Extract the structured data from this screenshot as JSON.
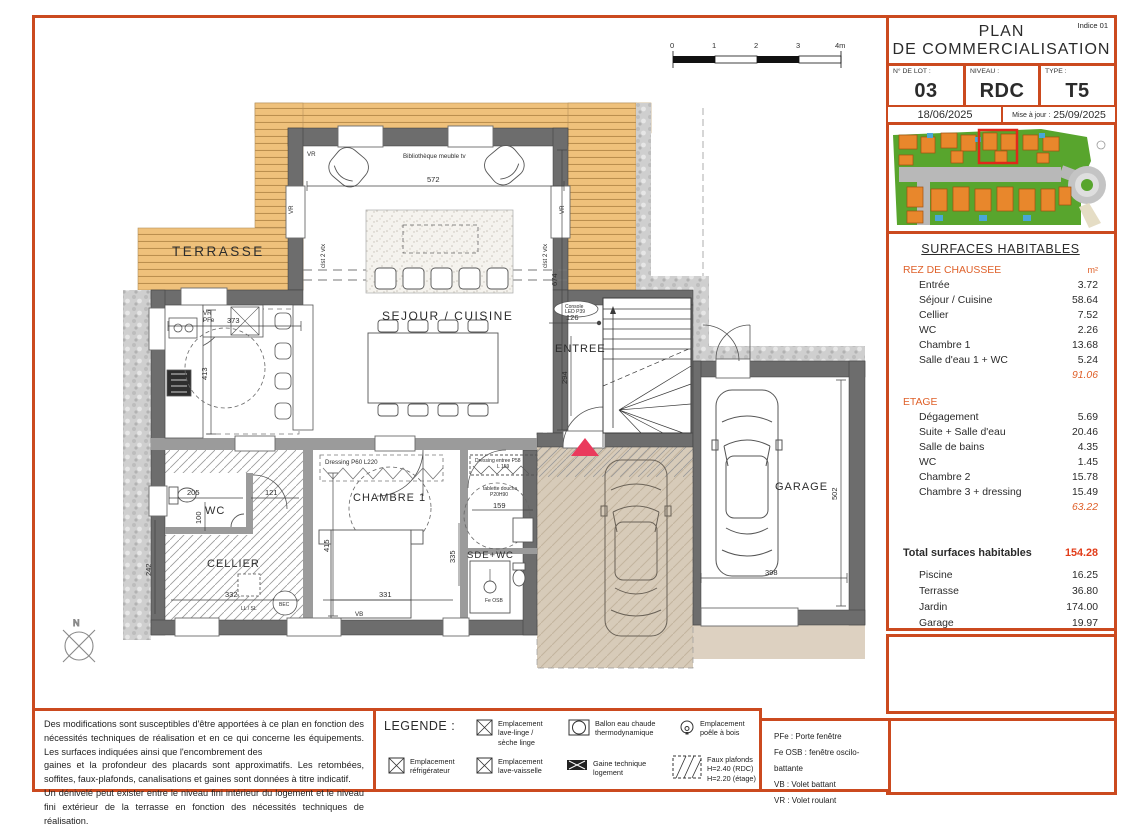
{
  "page": {
    "indice": "Indice 01",
    "title1": "PLAN",
    "title2": "DE COMMERCIALISATION"
  },
  "title_block": {
    "lot_label": "N° DE LOT :",
    "lot_value": "03",
    "niveau_label": "NIVEAU :",
    "niveau_value": "RDC",
    "type_label": "TYPE :",
    "type_value": "T5 PMR",
    "date": "18/06/2025",
    "maj_label": "Mise à jour :",
    "maj_value": "25/09/2025"
  },
  "surfaces": {
    "title": "SURFACES HABITABLES",
    "rdc_header": "REZ DE CHAUSSEE",
    "unit": "m²",
    "rdc_rows": [
      {
        "label": "Entrée",
        "value": "3.72"
      },
      {
        "label": "Séjour / Cuisine",
        "value": "58.64"
      },
      {
        "label": "Cellier",
        "value": "7.52"
      },
      {
        "label": "WC",
        "value": "2.26"
      },
      {
        "label": "Chambre 1",
        "value": "13.68"
      },
      {
        "label": "Salle d'eau 1 + WC",
        "value": "5.24"
      }
    ],
    "rdc_total": "91.06",
    "etage_header": "ETAGE",
    "etage_rows": [
      {
        "label": "Dégagement",
        "value": "5.69"
      },
      {
        "label": "Suite + Salle d'eau",
        "value": "20.46"
      },
      {
        "label": "Salle de bains",
        "value": "4.35"
      },
      {
        "label": "WC",
        "value": "1.45"
      },
      {
        "label": "Chambre 2",
        "value": "15.78"
      },
      {
        "label": "Chambre 3 + dressing",
        "value": "15.49"
      }
    ],
    "etage_total": "63.22",
    "total_label": "Total surfaces habitables",
    "total_value": "154.28",
    "extra_rows": [
      {
        "label": "Piscine",
        "value": "16.25"
      },
      {
        "label": "Terrasse",
        "value": "36.80"
      },
      {
        "label": "Jardin",
        "value": "174.00"
      },
      {
        "label": "Garage",
        "value": "19.97"
      }
    ]
  },
  "disclaimer": {
    "p1": "Des modifications sont susceptibles d'être apportées à ce plan en fonction des nécessités techniques de réalisation et en ce qui concerne les équipements. Les surfaces indiquées ainsi que l'encombrement des",
    "p2": "gaines et la profondeur des placards sont approximatifs. Les retombées, soffites, faux-plafonds, canalisations et gaines sont données à titre indicatif.",
    "p3": "Un dénivelé peut exister entre le niveau fini intérieur du logement et le niveau fini extérieur de la terrasse en fonction des nécessités techniques de réalisation."
  },
  "legend": {
    "title": "LEGENDE :",
    "items": [
      {
        "label": "Emplacement\nlave-linge /\nsèche linge"
      },
      {
        "label": "Ballon eau chaude\nthermodynamique"
      },
      {
        "label": "Emplacement\npoêle à bois"
      },
      {
        "label": "Emplacement\nréfrigérateur"
      },
      {
        "label": "Emplacement\nlave-vaisselle"
      },
      {
        "label": "Gaine technique\nlogement"
      },
      {
        "label": "Faux plafonds\nH=2.40 (RDC)\nH=2.20 (étage)"
      }
    ],
    "abbreviations": [
      {
        "text": "PFe : Porte fenêtre"
      },
      {
        "text": "Fe OSB : fenêtre oscilo-battante"
      },
      {
        "text": "VB : Volet battant"
      },
      {
        "text": "VR : Volet roulant"
      }
    ]
  },
  "plan": {
    "rooms": {
      "terrasse": "TERRASSE",
      "sejour": "SEJOUR / CUISINE",
      "entree": "ENTREE",
      "wc": "WC",
      "cellier": "CELLIER",
      "chambre1": "CHAMBRE 1",
      "sde": "SDE+WC",
      "garage": "GARAGE"
    },
    "ann": {
      "biblio": "Bibliothèque meuble tv",
      "vr": "VR",
      "pfe": "PFe",
      "vb": "VB",
      "feosb": "Fe OSB",
      "clst": "clst 2 vtx",
      "console1": "Console",
      "console2": "LED P39",
      "dressing1": "Dressing P60 L220",
      "dressing2": "Dressing entree P58",
      "dressing2b": "L 159",
      "tablette1": "tablette douche",
      "tablette2": "P20H90",
      "llsl": "LL / SL",
      "bec": "BEC",
      "north": "N"
    },
    "dims": {
      "d572": "572",
      "d674": "674",
      "d373": "373",
      "d413": "413",
      "d126": "126",
      "d294": "294",
      "d205": "205",
      "d100": "100",
      "d121": "121",
      "d242": "242",
      "d332": "332",
      "d415": "415",
      "d331": "331",
      "d335": "335",
      "d159a": "159",
      "d398": "398",
      "d502": "502"
    },
    "scale": [
      "0",
      "1",
      "2",
      "3",
      "4m"
    ]
  }
}
